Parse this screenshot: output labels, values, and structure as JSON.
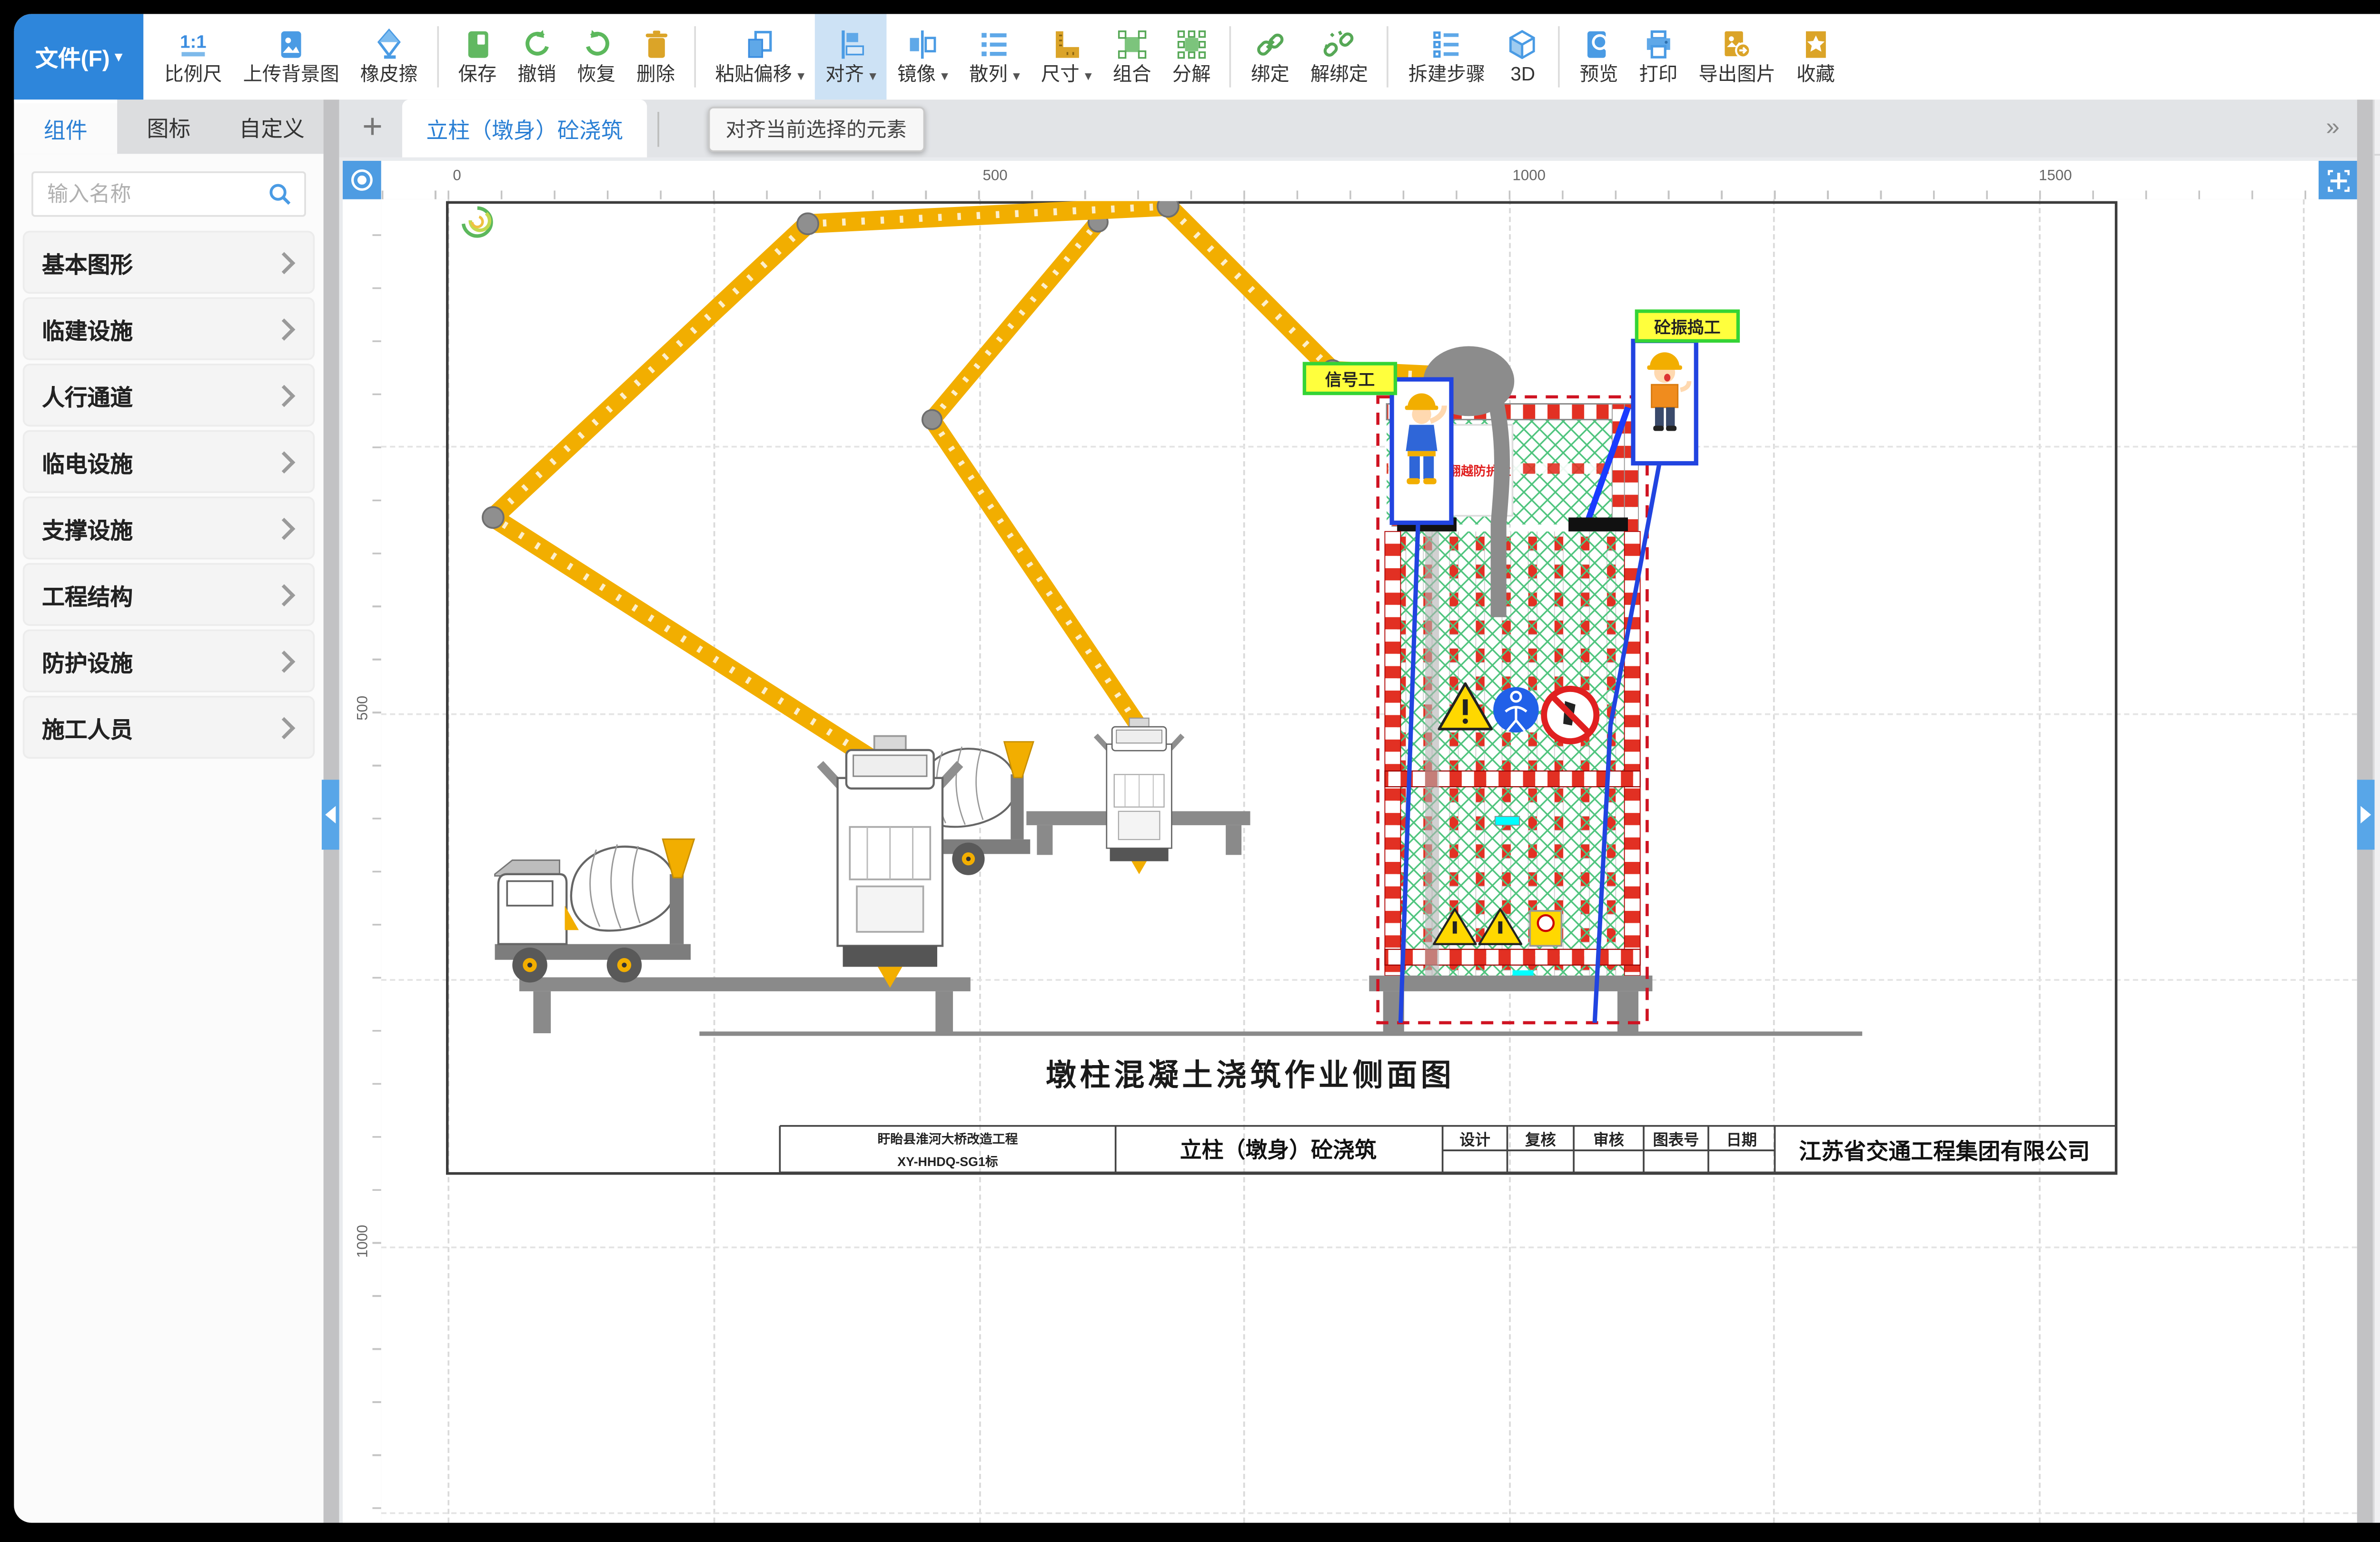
{
  "window": {
    "file_menu": "文件(F)",
    "file_caret": "▾"
  },
  "glyphs": {
    "plus": "+",
    "overflow": "»",
    "caret": "▾"
  },
  "toolbar": {
    "tooltip": "对齐当前选择的元素",
    "items": [
      {
        "label": "比例尺"
      },
      {
        "label": "上传背景图"
      },
      {
        "label": "橡皮擦"
      },
      {
        "label": "保存"
      },
      {
        "label": "撤销"
      },
      {
        "label": "恢复"
      },
      {
        "label": "删除"
      },
      {
        "label": "粘贴偏移",
        "caret": "▾"
      },
      {
        "label": "对齐",
        "caret": "▾",
        "active": true
      },
      {
        "label": "镜像",
        "caret": "▾"
      },
      {
        "label": "散列",
        "caret": "▾"
      },
      {
        "label": "尺寸",
        "caret": "▾"
      },
      {
        "label": "组合"
      },
      {
        "label": "分解"
      },
      {
        "label": "绑定"
      },
      {
        "label": "解绑定"
      },
      {
        "label": "拆建步骤"
      },
      {
        "label": "3D"
      },
      {
        "label": "预览"
      },
      {
        "label": "打印"
      },
      {
        "label": "导出图片"
      },
      {
        "label": "收藏"
      }
    ]
  },
  "sidebar": {
    "tabs": [
      "组件",
      "图标",
      "自定义"
    ],
    "active_tab": "组件",
    "search_placeholder": "输入名称",
    "categories": [
      "基本图形",
      "临建设施",
      "人行通道",
      "临电设施",
      "支撑设施",
      "工程结构",
      "防护设施",
      "施工人员"
    ]
  },
  "canvas": {
    "tab": "立柱（墩身）砼浇筑",
    "ruler_top": [
      "0",
      "500",
      "1000",
      "1500"
    ],
    "ruler_left": [
      "500",
      "1000"
    ]
  },
  "drawing": {
    "title": "墩柱混凝土浇筑作业侧面图",
    "fence_sign": "禁止翻越防护栏",
    "worker_labels": {
      "signal": "信号工",
      "vibrator": "砼振捣工"
    },
    "table": {
      "project_name": "盱眙县淮河大桥改造工程",
      "project_code": "XY-HHDQ-SG1标",
      "drawing_name": "立柱（墩身）砼浇筑",
      "headers": [
        "设计",
        "复核",
        "审核",
        "图表号",
        "日期"
      ],
      "company": "江苏省交通工程集团有限公司"
    }
  },
  "panel": {
    "tabs": [
      "属性",
      "图层"
    ],
    "active_tab": "属性",
    "fields": [
      {
        "label": "名称",
        "value": "背景"
      },
      {
        "label": "锁定",
        "value": "否"
      },
      {
        "label": "背景图",
        "value": "空"
      },
      {
        "label": "背景图管理",
        "value": "操作"
      },
      {
        "label": "适配背景图",
        "value": "否"
      },
      {
        "label": "网格吸附",
        "value": "否"
      },
      {
        "label": "图层",
        "value": "100"
      },
      {
        "label": "比例",
        "value": "69.45%"
      },
      {
        "label": "填充颜色",
        "value": "#000000"
      },
      {
        "label": "制图框尺寸",
        "value": "自定义"
      },
      {
        "label": "边框长度",
        "value": "1600"
      },
      {
        "label": "边框高度",
        "value": "900"
      },
      {
        "label": "信息框高度",
        "value": "50"
      },
      {
        "label": "边框颜色",
        "value": "#000000"
      },
      {
        "label": "边框宽度",
        "value": "1"
      },
      {
        "label": "字体大小",
        "value": "24"
      },
      {
        "label": "字体类型",
        "value": "Arial"
      },
      {
        "label": "X轴辅助线",
        "value": ""
      },
      {
        "label": "Y轴辅助线",
        "value": ""
      }
    ]
  },
  "colors": {
    "accent": "#2a7fd4",
    "file_button": "#2e86db",
    "active_tool_bg": "#cde2f5",
    "boom_yellow": "#f2ae00",
    "mesh_green": "#4ec47d",
    "danger_red": "#e23023",
    "selection_blue": "#2144e0",
    "label_yellow": "#ffff3d"
  }
}
